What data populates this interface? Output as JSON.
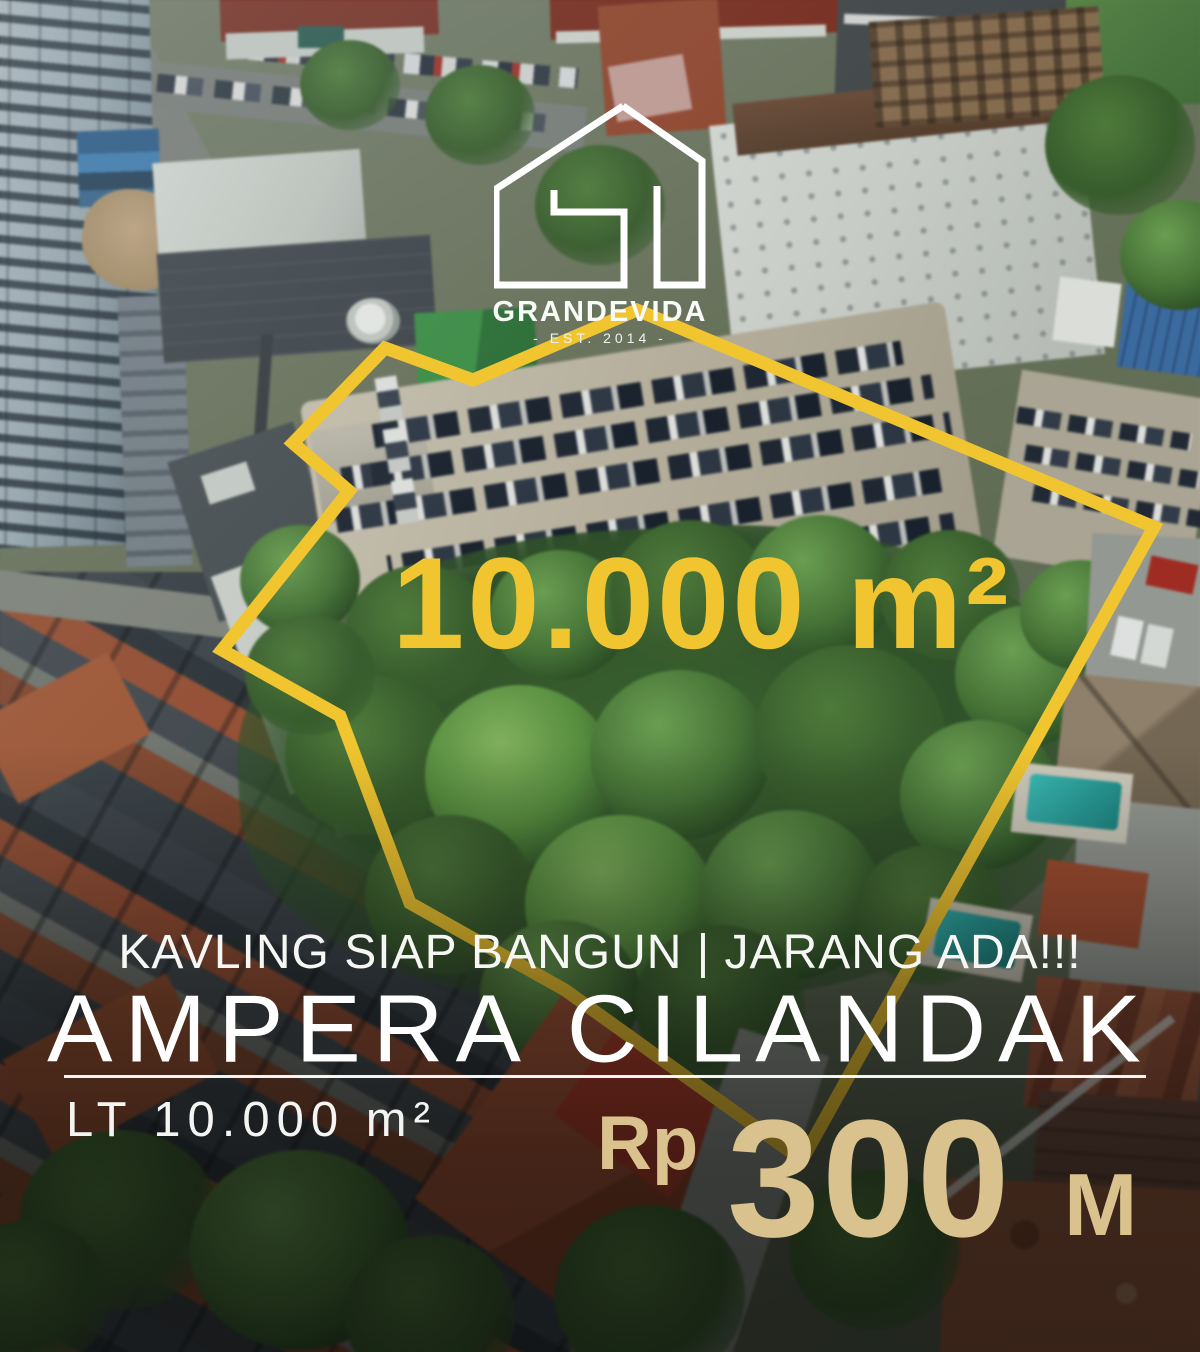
{
  "poster": {
    "brand": {
      "name": "GRANDEVIDA",
      "est_line": "- EST. 2014 -"
    },
    "land_area": "10.000 m²",
    "tagline": "KAVLING SIAP BANGUN | JARANG ADA!!!",
    "title": "AMPERA CILANDAK",
    "land_detail": "LT 10.000 m²",
    "price": {
      "currency": "Rp",
      "amount": "300",
      "unit": "M"
    },
    "colors": {
      "gold": "#F0C52F",
      "tan": "#D9C28E",
      "white": "#FFFFFF"
    }
  }
}
